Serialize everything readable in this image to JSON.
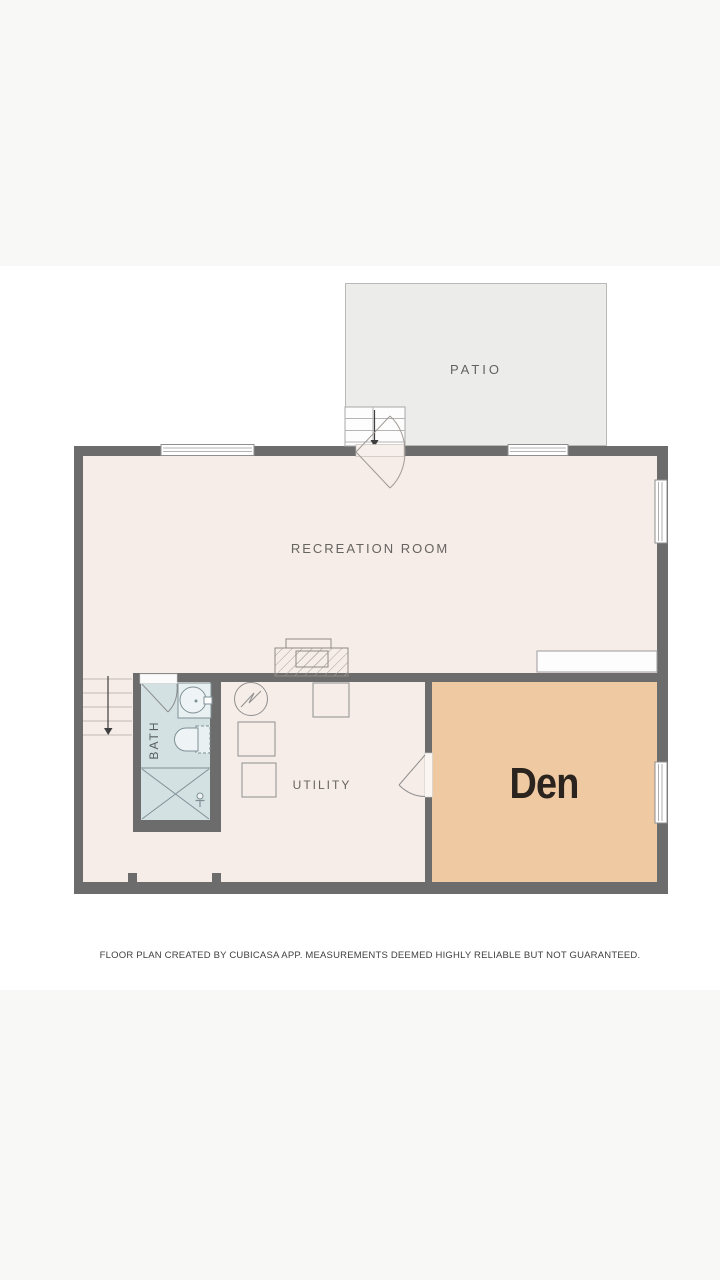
{
  "rooms": {
    "patio": {
      "label": "PATIO",
      "floor_color": "#ececeb"
    },
    "recreation_room": {
      "label": "RECREATION ROOM",
      "floor_color": "#f6ece8"
    },
    "bath": {
      "label": "BATH",
      "floor_color": "#d3e1e3"
    },
    "utility": {
      "label": "UTILITY",
      "floor_color": "#f6ece8"
    },
    "den": {
      "label": "Den",
      "floor_color": "#eec9a2"
    }
  },
  "footer": {
    "disclaimer": "FLOOR PLAN CREATED BY CUBICASA APP. MEASUREMENTS DEEMED HIGHLY RELIABLE BUT NOT GUARANTEED."
  },
  "colors": {
    "wall": "#6c6c6c",
    "page_margin_band": "#f8f8f6",
    "canvas_background": "#ffffff",
    "patio_border": "#b9b9b6",
    "room_label_text": "#666460",
    "den_label_text": "#2b241e",
    "fixture_outline": "#8f8f8f",
    "bath_fixture_outline": "#7e9096",
    "stair_tread_line": "#c2bab4",
    "arrow": "#3e3e3e"
  },
  "icons": [
    "exterior-stairs-icon",
    "interior-stairs-icon",
    "down-arrow-icon",
    "double-swing-door-icon",
    "door-swing-icon",
    "window-icon",
    "fireplace-icon",
    "counter-icon",
    "water-heater-icon",
    "appliance-icon",
    "sink-icon",
    "toilet-icon",
    "shower-icon",
    "shower-valve-icon"
  ]
}
